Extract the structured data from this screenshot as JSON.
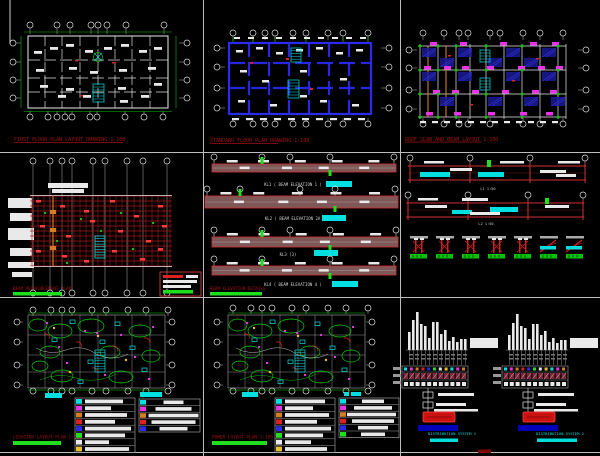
{
  "document": {
    "type": "cad-multi-drawing-sheet"
  },
  "colors": {
    "background": "#000000",
    "divider": "#bdbdbd",
    "white": "#e9e9e9",
    "green": "#00c800",
    "bright_green": "#1ede1e",
    "cyan": "#00e0e0",
    "red": "#e02020",
    "deep_red": "#a81414",
    "title_red": "#a01010",
    "beam_fill": "#7e5858",
    "beam_stroke": "#c03030",
    "magenta": "#e832e8",
    "blue": "#2a2af0",
    "hatch_blue": "#1a1a96",
    "dark_blue": "#0000bb",
    "orange": "#d08020",
    "yellow": "#e8c030",
    "gray": "#909090"
  },
  "panels": {
    "arch_plan": {
      "title": "FIRST FLOOR PLAN LAYOUT DRAWING 1:100"
    },
    "wall_plan": {
      "title": "STANDARD FLOOR PLAN DRAWING 1:100"
    },
    "framing_plan": {
      "title": "ROOF SLAB AND BEAM LAYOUT 1:100"
    },
    "beam_plan": {
      "title": "BEAM REINFORCEMENT PLAN"
    },
    "beam_elevations": {
      "title": "BEAM ELEVATION DETAILS",
      "items": [
        {
          "caption": "KL1 ( BEAM ELEVATION 1 )"
        },
        {
          "caption": "KL2 ( BEAM ELEVATION 2A )"
        },
        {
          "caption": "KL3 (3)"
        },
        {
          "caption": "KL4 ( BEAM ELEVATION 4 )"
        }
      ]
    },
    "beam_sections": {
      "beam_captions": [
        "L1  1:50",
        "L2  1:50"
      ],
      "section_count": 7
    },
    "lighting_plan": {
      "title": "LIGHTING LAYOUT PLAN 1:100"
    },
    "power_plan": {
      "title": "POWER LAYOUT PLAN 1:100"
    },
    "riser_diagrams": {
      "captions": [
        "DISTRIBUTION SYSTEM 1",
        "DISTRIBUTION SYSTEM 2"
      ],
      "left_bar_heights": [
        18,
        30,
        38,
        26,
        24,
        12,
        28,
        28,
        16,
        20,
        9,
        13,
        8,
        11,
        11
      ],
      "right_bar_heights": [
        15,
        27,
        36,
        24,
        22,
        11,
        26,
        26,
        15,
        19,
        8,
        12,
        7,
        10,
        10
      ]
    }
  },
  "legend": {
    "swatch_colors": [
      "#00e0e0",
      "#e832e8",
      "#d08020",
      "#e02020",
      "#2a2af0",
      "#1ede1e",
      "#e9e9e9",
      "#e8c030"
    ],
    "left_table_bar_widths": [
      38,
      26,
      42,
      30,
      46,
      40,
      24,
      44
    ],
    "right_table_bar_widths": [
      20,
      36,
      50,
      44,
      28
    ],
    "power_left_widths": [
      40,
      28,
      44,
      32,
      46,
      38,
      26,
      42
    ],
    "power_right_widths": [
      22,
      38,
      52,
      42,
      30,
      24
    ]
  }
}
